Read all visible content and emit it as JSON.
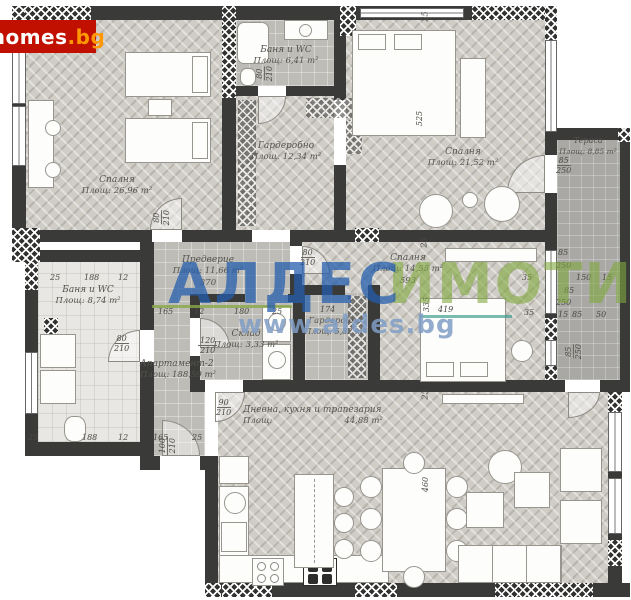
{
  "logo": {
    "main": "homes",
    "suffix": ".bg"
  },
  "watermark": {
    "brand": "АЛДЕС",
    "brand_suffix": "ИМОТИ",
    "url": "www.aldes.bg"
  },
  "apartment": {
    "name": "Апартамент-2",
    "area": "Площ: 188,59 m²"
  },
  "rooms": {
    "bedroom1": {
      "name": "Спалня",
      "area": "Площ: 26,96 m²"
    },
    "bath1": {
      "name": "Баня и WC",
      "area": "Площ: 6,41 m²"
    },
    "wardrobe1": {
      "name": "Гардеробно",
      "area": "Площ: 12,34 m²"
    },
    "bedroom2": {
      "name": "Спалня",
      "area": "Площ: 21,52 m²"
    },
    "terrace": {
      "name": "Тераса",
      "area": "Площ: 8,85 m²"
    },
    "hall": {
      "name": "Предверие",
      "area": "Площ: 11,66 m²",
      "width": "370"
    },
    "bath2": {
      "name": "Баня и WC",
      "area": "Площ: 8,74 m²"
    },
    "storage": {
      "name": "Склад",
      "area": "Площ: 3,33 m²"
    },
    "wardrobe2": {
      "name": "Гардеробно",
      "area": "Площ: 5,82 m²",
      "width": "174"
    },
    "bedroom3": {
      "name": "Спалня",
      "area": "Площ: 14,55 m²",
      "width": "593"
    },
    "living": {
      "name": "Дневна, кухня и трапезария",
      "area_label": "Площ:",
      "area_value": "44,88 m²"
    }
  },
  "doors": {
    "bedroom1": [
      "80",
      "210"
    ],
    "bath1": [
      "80",
      "210"
    ],
    "bedroom3": [
      "80",
      "210"
    ],
    "bath2": [
      "80",
      "210"
    ],
    "storage": [
      "120",
      "210"
    ],
    "living": [
      "90",
      "210"
    ],
    "corridor": [
      "100",
      "210"
    ],
    "terrace_top": [
      "85",
      "250"
    ],
    "terrace_bottom": [
      "85",
      "250"
    ]
  },
  "dims": {
    "vchain": [
      "25",
      "525",
      "25",
      "335",
      "25",
      "460"
    ],
    "bed3_len": "419",
    "bath2_top": [
      "25",
      "188",
      "12"
    ],
    "bath2_bottom": [
      "25",
      "188",
      "12",
      "165",
      "25"
    ],
    "hall_left": [
      "165",
      "12"
    ],
    "storage_top": [
      "180",
      "25"
    ],
    "right_chain": [
      "85",
      "250",
      "150",
      "15",
      "85",
      "250",
      "15",
      "85",
      "50"
    ],
    "wall_a": "35",
    "wall_b": "35"
  }
}
